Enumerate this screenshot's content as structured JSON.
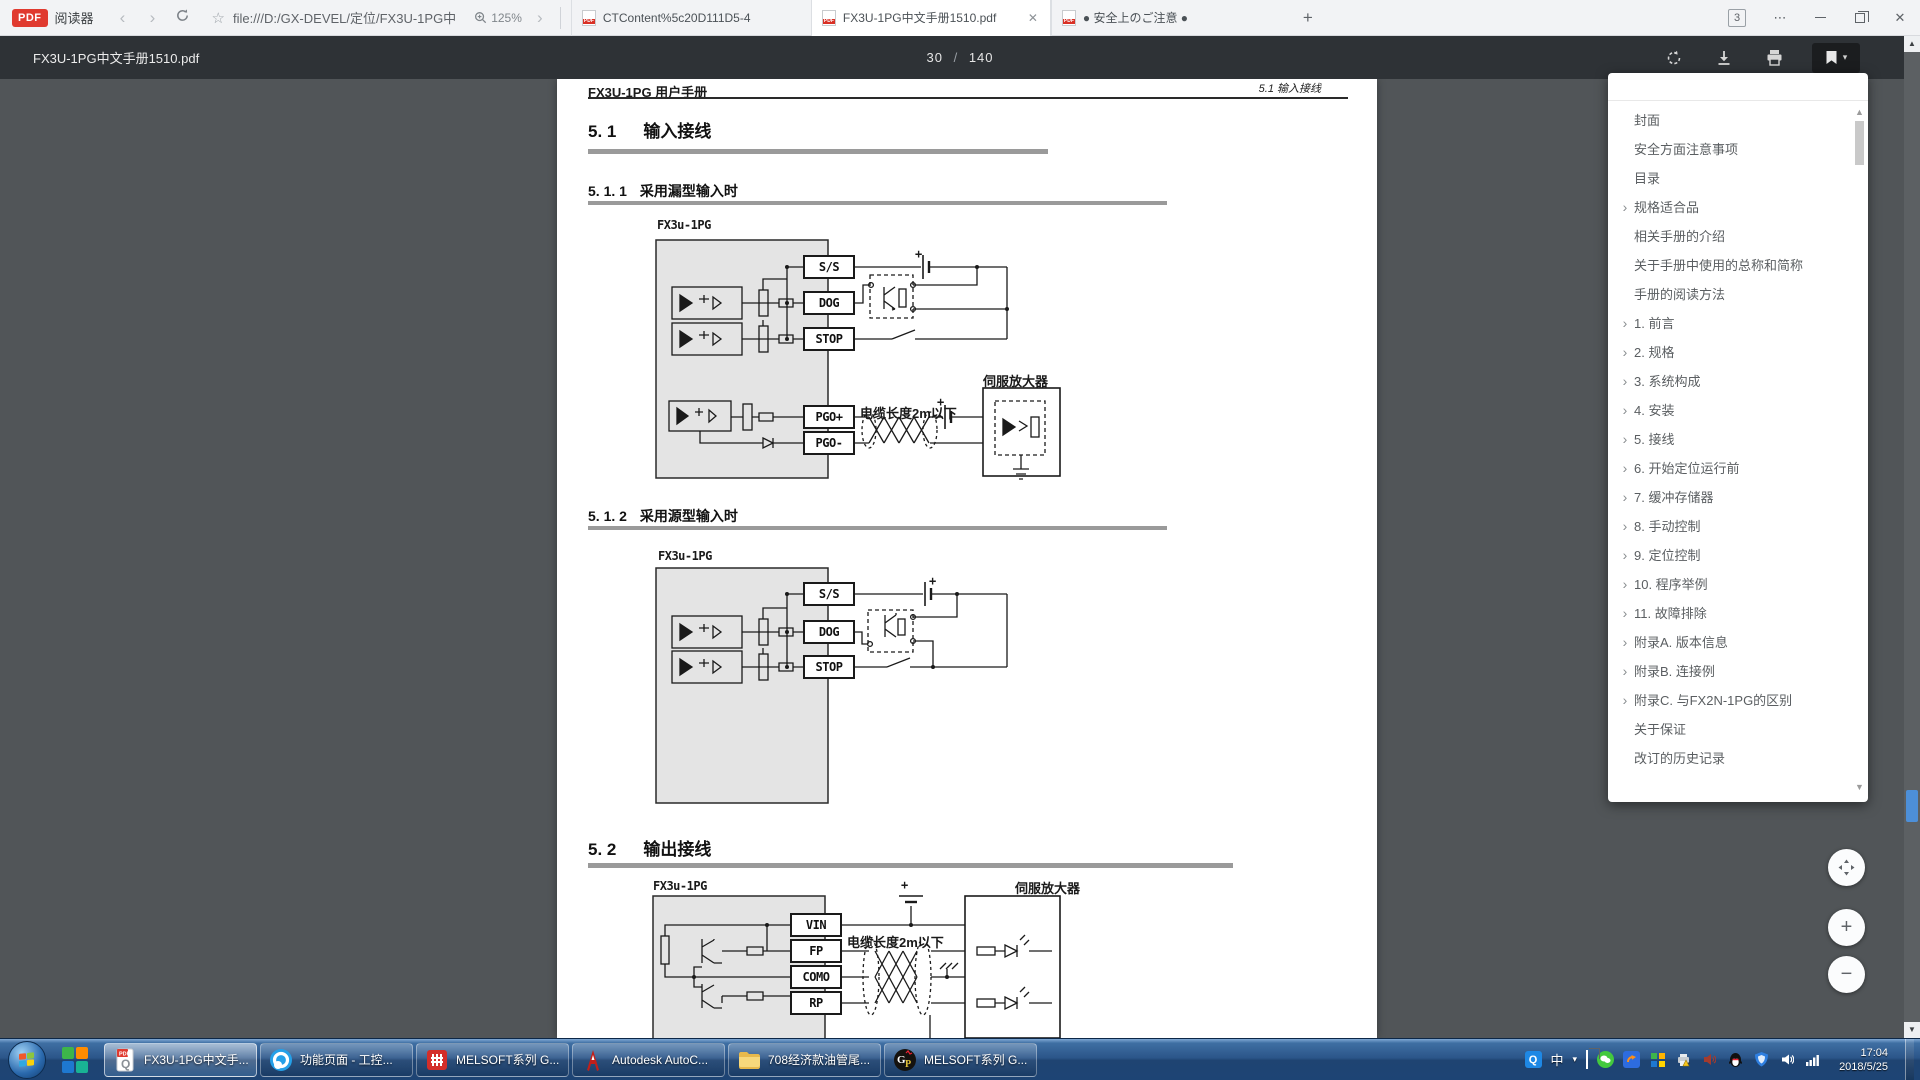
{
  "browser": {
    "brand": {
      "badge": "PDF",
      "label": "阅读器"
    },
    "nav": {
      "back": "‹",
      "forward": "›"
    },
    "address": {
      "star": "☆",
      "url": "file:///D:/GX-DEVEL/定位/FX3U-1PG中",
      "zoom_level": "125%",
      "chevron": "›"
    },
    "tabs": [
      {
        "title": "CTContent%5c20D111D5-4"
      },
      {
        "title": "FX3U-1PG中文手册1510.pdf",
        "close": "✕"
      },
      {
        "title": "● 安全上のご注意 ●"
      }
    ],
    "new_tab": "+",
    "tab_count": "3",
    "menu": "⋯",
    "close": "✕"
  },
  "pdf_toolbar": {
    "title": "FX3U-1PG中文手册1510.pdf",
    "page_current": "30",
    "page_sep": "/",
    "page_total": "140",
    "bookmark_caret": "▾"
  },
  "document": {
    "header_left": "FX3U-1PG 用户手册",
    "header_right": "5.1 输入接线",
    "s51": {
      "num": "5. 1",
      "title": "输入接线"
    },
    "s511": {
      "num": "5. 1. 1",
      "title": "采用漏型输入时"
    },
    "s512": {
      "num": "5. 1. 2",
      "title": "采用源型输入时"
    },
    "s52": {
      "num": "5. 2",
      "title": "输出接线"
    },
    "diagram1": {
      "device": "FX3u-1PG",
      "terminals": [
        "S/S",
        "DOG",
        "STOP",
        "PGO+",
        "PGO-"
      ],
      "servo": "伺服放大器",
      "cable_note": "电缆长度2m以下",
      "plus1": "+",
      "plus2": "+"
    },
    "diagram2": {
      "device": "FX3u-1PG",
      "terminals": [
        "S/S",
        "DOG",
        "STOP"
      ],
      "plus1": "+"
    },
    "diagram3": {
      "device": "FX3u-1PG",
      "terminals": [
        "VIN",
        "FP",
        "COMO",
        "RP"
      ],
      "servo": "伺服放大器",
      "cable_note": "电缆长度2m以下",
      "plus1": "+"
    }
  },
  "toc": {
    "up": "▲",
    "down": "▼",
    "items": [
      {
        "label": "封面"
      },
      {
        "label": "安全方面注意事项"
      },
      {
        "label": "目录"
      },
      {
        "chevron": "›",
        "label": "规格适合品"
      },
      {
        "label": "相关手册的介绍"
      },
      {
        "label": "关于手册中使用的总称和简称"
      },
      {
        "label": "手册的阅读方法"
      },
      {
        "chevron": "›",
        "label": "1. 前言"
      },
      {
        "chevron": "›",
        "label": "2. 规格"
      },
      {
        "chevron": "›",
        "label": "3. 系统构成"
      },
      {
        "chevron": "›",
        "label": "4. 安装"
      },
      {
        "chevron": "›",
        "label": "5. 接线"
      },
      {
        "chevron": "›",
        "label": "6. 开始定位运行前"
      },
      {
        "chevron": "›",
        "label": "7. 缓冲存储器"
      },
      {
        "chevron": "›",
        "label": "8. 手动控制"
      },
      {
        "chevron": "›",
        "label": "9. 定位控制"
      },
      {
        "chevron": "›",
        "label": "10. 程序举例"
      },
      {
        "chevron": "›",
        "label": "11. 故障排除"
      },
      {
        "chevron": "›",
        "label": "附录A. 版本信息"
      },
      {
        "chevron": "›",
        "label": "附录B. 连接例"
      },
      {
        "chevron": "›",
        "label": "附录C. 与FX2N-1PG的区别"
      },
      {
        "label": "关于保证"
      },
      {
        "label": "改订的历史记录"
      }
    ]
  },
  "float_controls": {
    "zoom_in": "+",
    "zoom_out": "−"
  },
  "scrollbar": {
    "up": "▲",
    "down": "▼"
  },
  "taskbar": {
    "apps": [
      {
        "label": "FX3U-1PG中文手..."
      },
      {
        "label": "功能页面 - 工控..."
      },
      {
        "label": "MELSOFT系列 G..."
      },
      {
        "label": "Autodesk AutoC..."
      },
      {
        "label": "708经济款油管尾..."
      },
      {
        "label": "MELSOFT系列 G..."
      }
    ],
    "tray": {
      "ime": "中",
      "caret": "▾",
      "time": "17:04",
      "date": "2018/5/25"
    }
  }
}
